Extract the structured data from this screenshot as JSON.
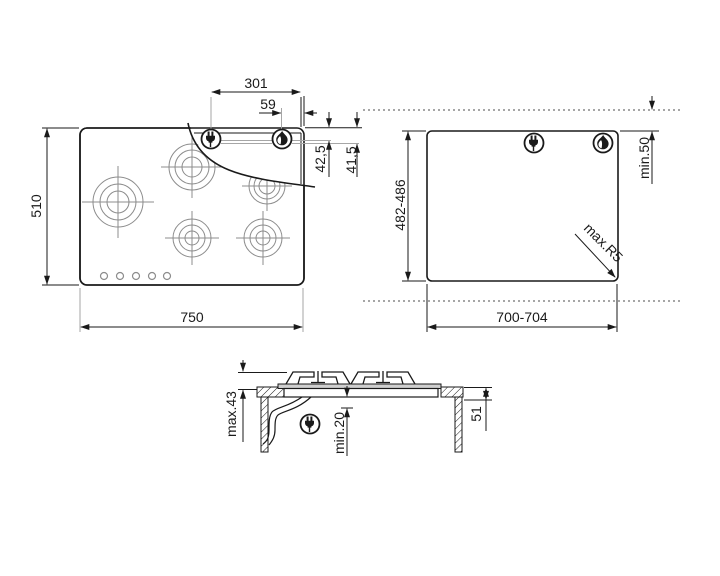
{
  "drawing": {
    "title": "gas-hob-installation-dimensions",
    "colors": {
      "line": "#1a1a1a",
      "gray_line": "#a6a6a6",
      "burner_gray": "#8c8c8c",
      "flange_fill": "#cfcfcf",
      "dotted": "#4d4d4d",
      "background": "#ffffff"
    },
    "icons": {
      "electrical": "power-plug-icon",
      "gas": "gas-flame-icon"
    },
    "top_view": {
      "description": "hob seen from above with 5 burners and peeled corner",
      "labels": {
        "overall_width": "750",
        "overall_depth": "510",
        "plug_offset": "301",
        "gas_offset": "59",
        "rear_clearance_a": "42,5",
        "rear_clearance_b": "41,5"
      }
    },
    "cutout_view": {
      "description": "worktop cutout dimensions",
      "labels": {
        "cutout_width": "700-704",
        "cutout_depth": "482-486",
        "rear_distance": "min.50",
        "corner_radius": "max.R5"
      }
    },
    "side_view": {
      "description": "cross-section of hob mounted in worktop",
      "labels": {
        "height_above_top": "max.43",
        "clearance_below": "min.20",
        "build_in_depth": "51"
      }
    }
  }
}
